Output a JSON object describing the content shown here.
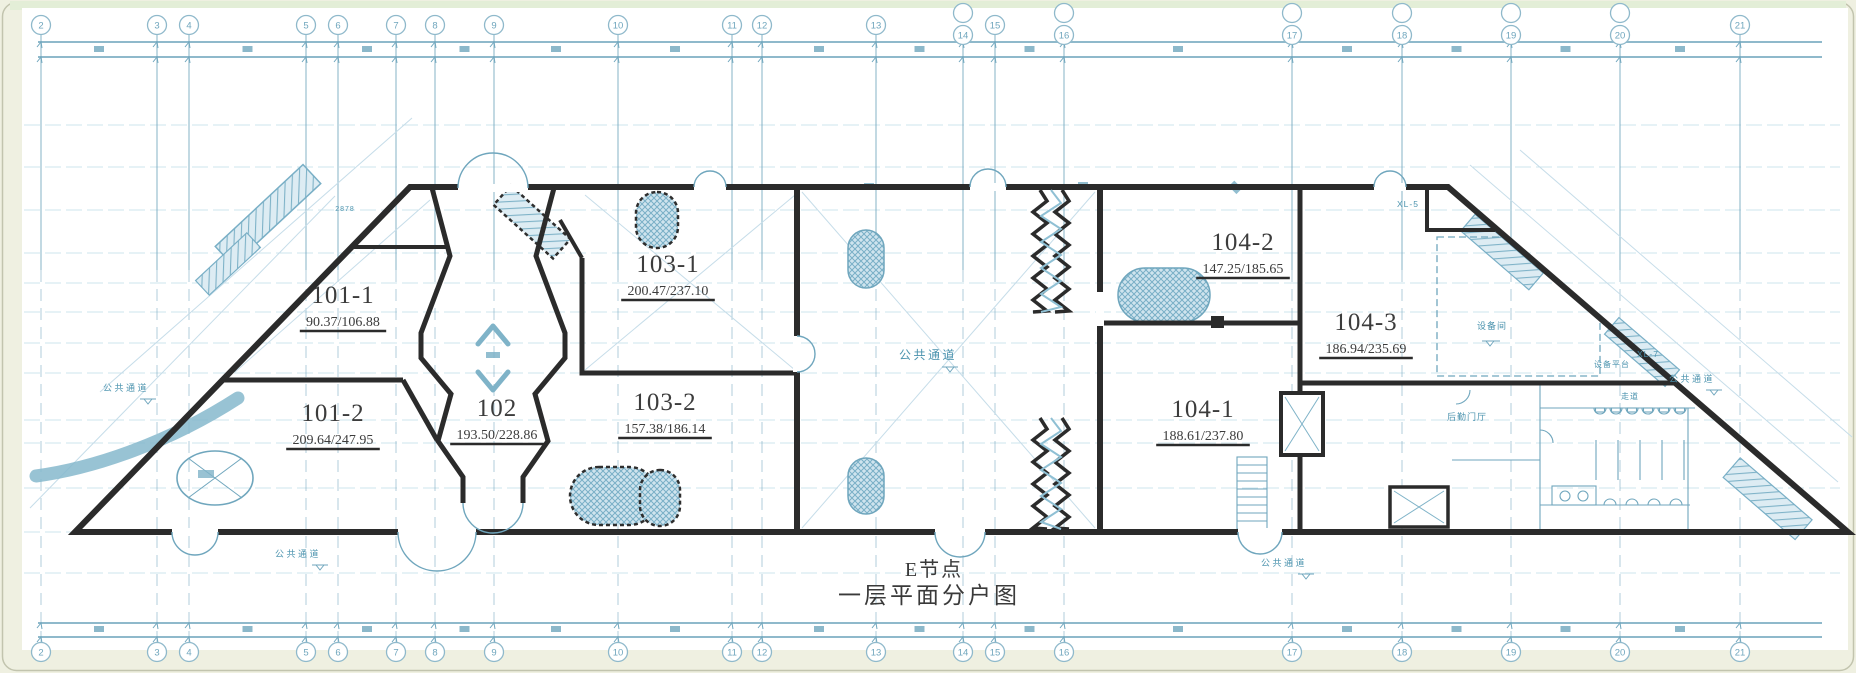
{
  "drawing": {
    "title_line1": "E节点",
    "title_line2": "一层平面分户图"
  },
  "units": [
    {
      "id": "101-1",
      "area": "90.37/106.88",
      "x": 343,
      "y": 303
    },
    {
      "id": "101-2",
      "area": "209.64/247.95",
      "x": 333,
      "y": 421
    },
    {
      "id": "102",
      "area": "193.50/228.86",
      "x": 497,
      "y": 416
    },
    {
      "id": "103-1",
      "area": "200.47/237.10",
      "x": 668,
      "y": 272
    },
    {
      "id": "103-2",
      "area": "157.38/186.14",
      "x": 665,
      "y": 410
    },
    {
      "id": "104-1",
      "area": "188.61/237.80",
      "x": 1203,
      "y": 417
    },
    {
      "id": "104-2",
      "area": "147.25/185.65",
      "x": 1243,
      "y": 250
    },
    {
      "id": "104-3",
      "area": "186.94/235.69",
      "x": 1366,
      "y": 330
    }
  ],
  "corridor_labels": [
    {
      "text": "公共通道",
      "x": 126,
      "y": 391,
      "fs": 9
    },
    {
      "text": "公共通道",
      "x": 298,
      "y": 557,
      "fs": 9
    },
    {
      "text": "公共通道",
      "x": 928,
      "y": 359,
      "fs": 12
    },
    {
      "text": "公共通道",
      "x": 1692,
      "y": 382,
      "fs": 9
    },
    {
      "text": "公共通道",
      "x": 1284,
      "y": 566,
      "fs": 9
    }
  ],
  "annotations": [
    {
      "text": "设备间",
      "x": 1492,
      "y": 329,
      "fs": 9
    },
    {
      "text": "设备平台",
      "x": 1612,
      "y": 367,
      "fs": 8
    },
    {
      "text": "XL-5",
      "x": 1408,
      "y": 207,
      "fs": 8.5
    },
    {
      "text": "XL-7",
      "x": 1648,
      "y": 357,
      "fs": 8.5
    },
    {
      "text": "后勤门厅",
      "x": 1467,
      "y": 420,
      "fs": 9
    },
    {
      "text": "走道",
      "x": 1630,
      "y": 399,
      "fs": 8
    },
    {
      "text": "2878",
      "x": 345,
      "y": 211,
      "fs": 7
    }
  ],
  "grid": {
    "columns": [
      {
        "x": 41,
        "label": "2"
      },
      {
        "x": 157,
        "label": "3"
      },
      {
        "x": 189,
        "label": "4"
      },
      {
        "x": 306,
        "label": "5"
      },
      {
        "x": 338,
        "label": "6"
      },
      {
        "x": 396,
        "label": "7"
      },
      {
        "x": 435,
        "label": "8"
      },
      {
        "x": 494,
        "label": "9"
      },
      {
        "x": 618,
        "label": "10"
      },
      {
        "x": 732,
        "label": "11"
      },
      {
        "x": 762,
        "label": "12"
      },
      {
        "x": 876,
        "label": "13"
      },
      {
        "x": 963,
        "label": "14",
        "stacked": true
      },
      {
        "x": 995,
        "label": "15"
      },
      {
        "x": 1064,
        "label": "16",
        "stacked": true
      },
      {
        "x": 1292,
        "label": "17",
        "stacked": true
      },
      {
        "x": 1402,
        "label": "18",
        "stacked": true
      },
      {
        "x": 1511,
        "label": "19",
        "stacked": true
      },
      {
        "x": 1620,
        "label": "20",
        "stacked": true
      },
      {
        "x": 1740,
        "label": "21"
      }
    ],
    "rows_y": [
      125,
      167,
      210,
      253,
      283,
      312,
      343,
      373,
      420,
      443,
      488,
      532,
      573
    ]
  },
  "colors": {
    "wall": "#2b2b2b",
    "blue": "#6fa6bd",
    "blue_mid": "#8fb9cb",
    "blue_light": "#9ec7d8",
    "blue_faint": "#c9e2ec",
    "text_dark": "#3c3c3c",
    "frame": "#eff0e1"
  }
}
